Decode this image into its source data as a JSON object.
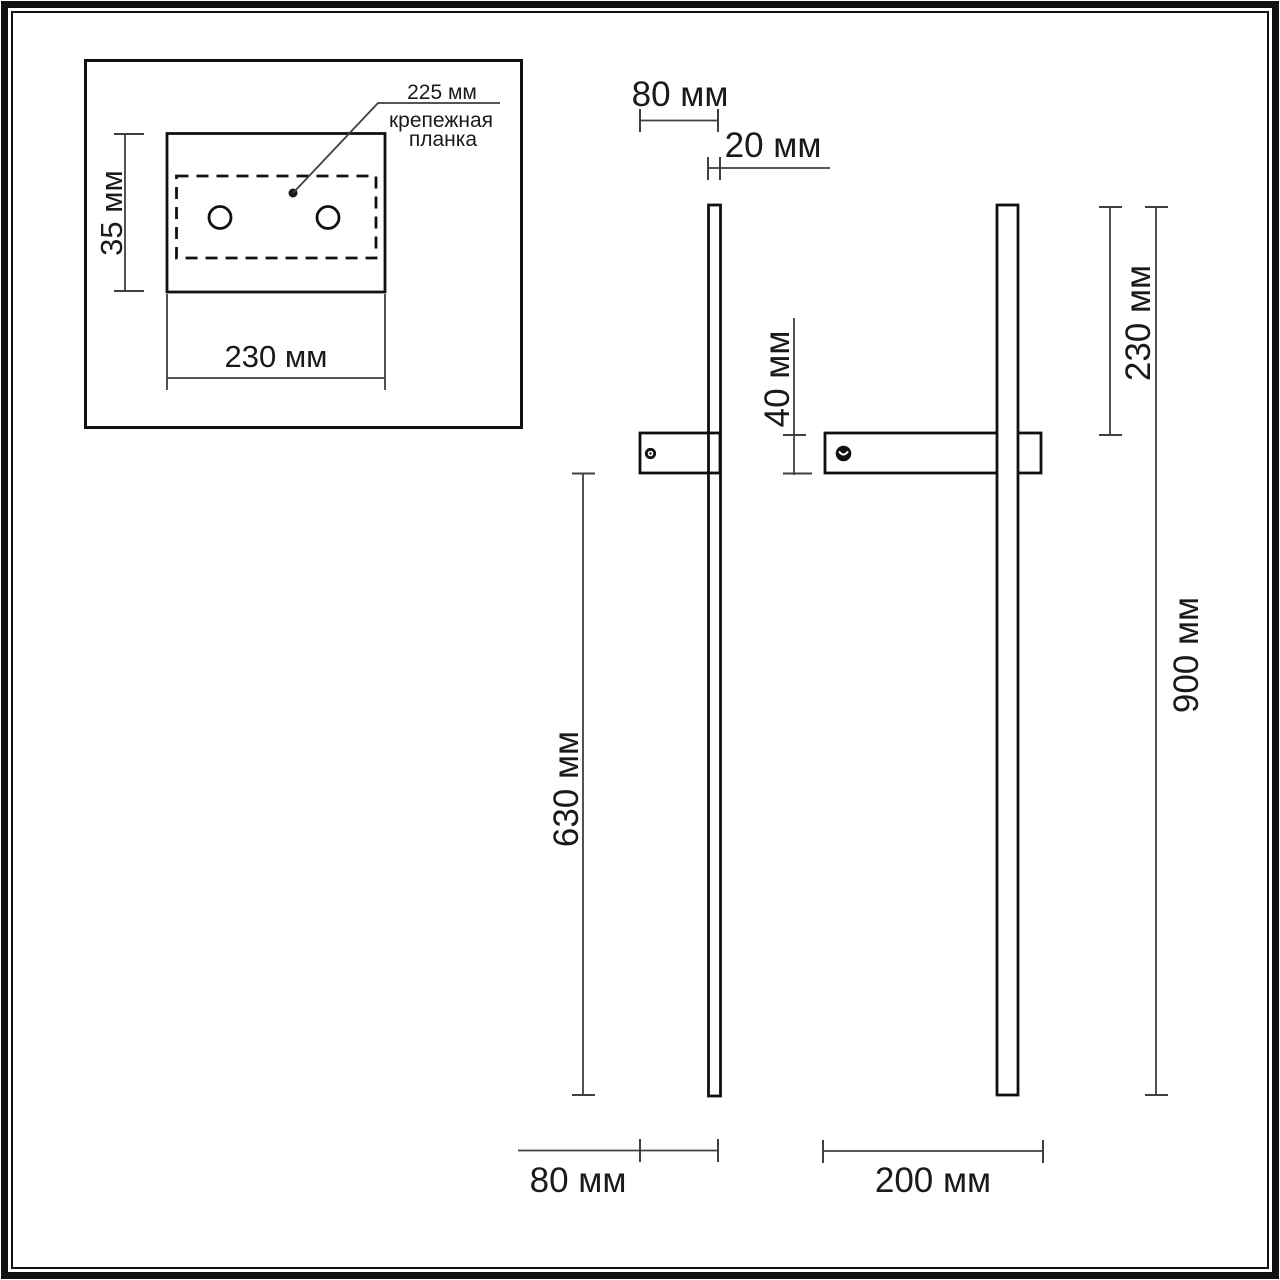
{
  "colors": {
    "object_line": "#111111",
    "dim_line": "#3f3f3f",
    "text": "#1a1a1a",
    "background": "#ffffff",
    "screw": "#111111"
  },
  "inset": {
    "plate_length_label": "225 мм",
    "plate_caption_line1": "крепежная",
    "plate_caption_line2": "планка",
    "height_label": "35 мм",
    "width_label": "230 мм"
  },
  "side_view": {
    "bracket_depth_label": "80 мм",
    "profile_thickness_label": "20 мм",
    "bracket_height_label": "40 мм",
    "lower_length_label": "630 мм",
    "bottom_bracket_depth_label": "80 мм"
  },
  "front_view": {
    "upper_length_label": "230 мм",
    "overall_length_label": "900 мм",
    "bracket_width_label": "200 мм"
  }
}
